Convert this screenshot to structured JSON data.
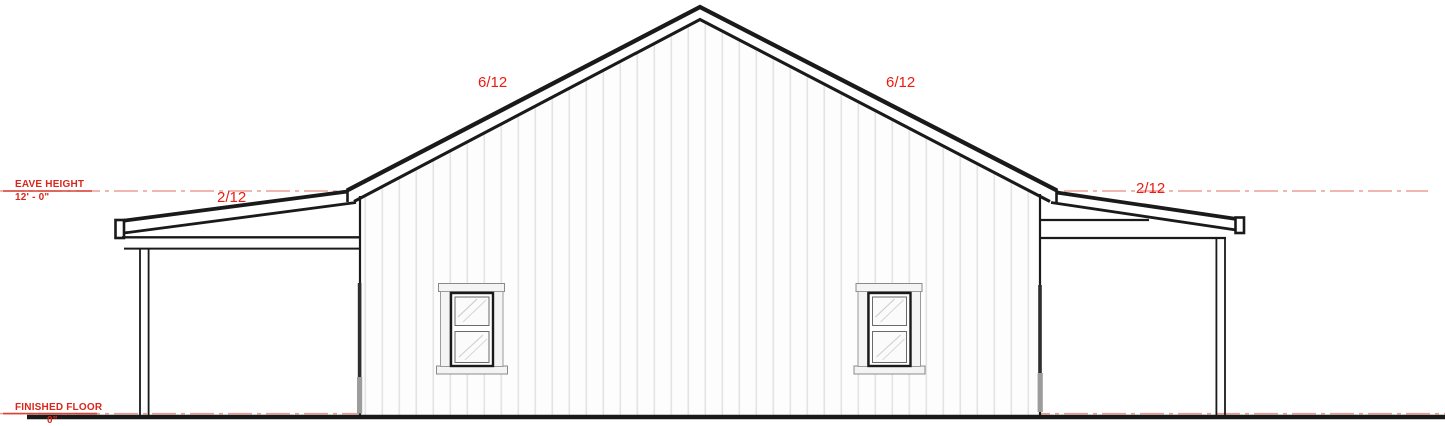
{
  "annotations": {
    "eave_height": {
      "label": "EAVE HEIGHT",
      "value": "12' - 0\""
    },
    "finished_floor": {
      "label": "FINISHED FLOOR",
      "value": "0\""
    },
    "pitch": {
      "main_roof_left": "6/12",
      "main_roof_right": "6/12",
      "left_shed_roof": "2/12",
      "right_shed_roof": "2/12"
    }
  },
  "colors": {
    "annotation_red": "#d8281c",
    "pitch_red": "#ea1c12",
    "reference_line_red": "#ec9d96",
    "drawing_line_black": "#1a1a1a",
    "siding_line_gray": "#e4e4e4",
    "trim_gray": "#f4f4f4",
    "downspout_gray": "#9c9c9c"
  }
}
